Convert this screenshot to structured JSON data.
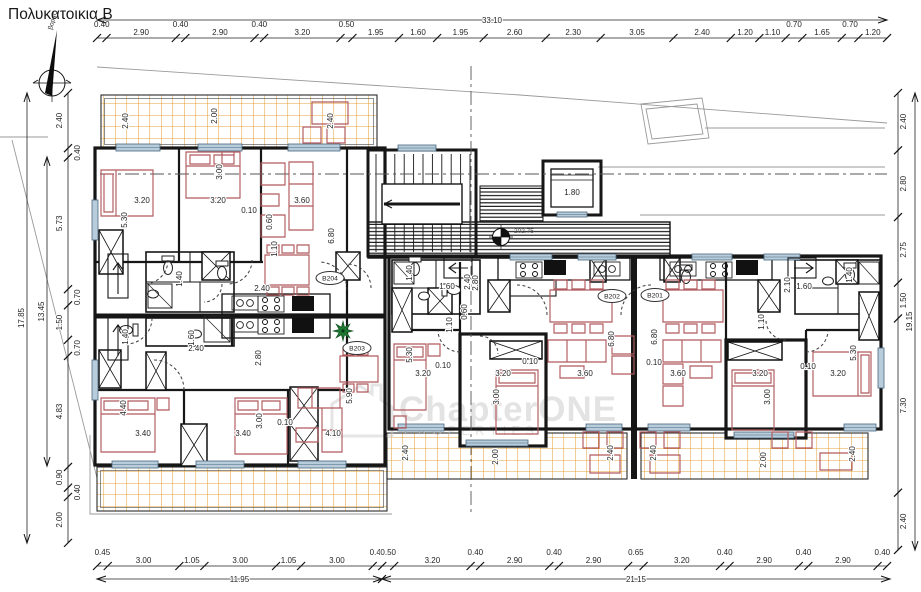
{
  "title": "Πολυκατοικια Β",
  "north_label": "βορας",
  "watermark": {
    "brand": "ChapterONE",
    "sub": "PROPERTIES"
  },
  "level_marker": "202.75",
  "apartments": [
    {
      "id": "B204",
      "x": 330,
      "y": 278
    },
    {
      "id": "B203",
      "x": 357,
      "y": 348
    },
    {
      "id": "B202",
      "x": 612,
      "y": 296
    },
    {
      "id": "B201",
      "x": 655,
      "y": 295
    }
  ],
  "chains": {
    "top": {
      "overall": "33.10",
      "segments": [
        "0.40",
        "2.90",
        "0.40",
        "2.90",
        "0.40",
        "3.20",
        "0.50",
        "1.95",
        "1.60",
        "1.95",
        "2.60",
        "2.30",
        "3.05",
        "2.40",
        "1.20",
        "1.10",
        "0.70",
        "1.65",
        "0.70",
        "1.20"
      ]
    },
    "bottom": {
      "overall_left": "11.95",
      "overall_right": "21.15",
      "segments": [
        "0.45",
        "3.00",
        "1.05",
        "3.00",
        "1.05",
        "3.00",
        "0.40",
        "0.50",
        "3.20",
        "0.40",
        "2.90",
        "0.40",
        "2.90",
        "0.65",
        "3.20",
        "0.40",
        "2.90",
        "0.40",
        "2.90",
        "0.40"
      ]
    },
    "left": {
      "overall_outer": "17.85",
      "overall_inner": "13.45",
      "segments": [
        "2.40",
        "0.40",
        "5.73",
        "0.70",
        "1.50",
        "0.70",
        "4.83",
        "0.90",
        "0.40",
        "2.00"
      ]
    },
    "right": {
      "overall": "19.15",
      "segments": [
        "2.40",
        "2.80",
        "2.75",
        "1.50",
        "7.30",
        "2.40"
      ]
    }
  },
  "interior_dimensions": [
    {
      "t": "3.20",
      "x": 142,
      "y": 203
    },
    {
      "t": "3.20",
      "x": 218,
      "y": 203
    },
    {
      "t": "3.60",
      "x": 302,
      "y": 203
    },
    {
      "t": "0.10",
      "x": 249,
      "y": 213
    },
    {
      "t": "5.30",
      "x": 127,
      "y": 220,
      "r": -90
    },
    {
      "t": "3.00",
      "x": 222,
      "y": 172,
      "r": -90
    },
    {
      "t": "6.80",
      "x": 334,
      "y": 236,
      "r": -90
    },
    {
      "t": "0.60",
      "x": 272,
      "y": 222,
      "r": -90
    },
    {
      "t": "1.10",
      "x": 277,
      "y": 249,
      "r": -90
    },
    {
      "t": "1.40",
      "x": 182,
      "y": 279,
      "r": -90
    },
    {
      "t": "2.80",
      "x": 478,
      "y": 283,
      "r": -90
    },
    {
      "t": "1.40",
      "x": 128,
      "y": 337,
      "r": -90
    },
    {
      "t": "1.60",
      "x": 194,
      "y": 338,
      "r": -90
    },
    {
      "t": "2.40",
      "x": 196,
      "y": 351
    },
    {
      "t": "2.80",
      "x": 261,
      "y": 358,
      "r": -90
    },
    {
      "t": "2.40",
      "x": 262,
      "y": 291
    },
    {
      "t": "3.40",
      "x": 143,
      "y": 436
    },
    {
      "t": "3.40",
      "x": 243,
      "y": 436
    },
    {
      "t": "4.10",
      "x": 333,
      "y": 436
    },
    {
      "t": "0.10",
      "x": 285,
      "y": 425
    },
    {
      "t": "4.40",
      "x": 126,
      "y": 408,
      "r": -90
    },
    {
      "t": "3.00",
      "x": 262,
      "y": 421,
      "r": -90
    },
    {
      "t": "5.90",
      "x": 352,
      "y": 396,
      "r": -90
    },
    {
      "t": "3.20",
      "x": 423,
      "y": 376
    },
    {
      "t": "3.20",
      "x": 503,
      "y": 376
    },
    {
      "t": "3.60",
      "x": 585,
      "y": 376
    },
    {
      "t": "0.10",
      "x": 443,
      "y": 368
    },
    {
      "t": "0.10",
      "x": 530,
      "y": 364
    },
    {
      "t": "5.30",
      "x": 412,
      "y": 355,
      "r": -90
    },
    {
      "t": "3.00",
      "x": 499,
      "y": 397,
      "r": -90
    },
    {
      "t": "6.80",
      "x": 614,
      "y": 339,
      "r": -90
    },
    {
      "t": "1.10",
      "x": 452,
      "y": 325,
      "r": -90
    },
    {
      "t": "0.60",
      "x": 467,
      "y": 312,
      "r": -90
    },
    {
      "t": "1.40",
      "x": 412,
      "y": 273,
      "r": -90
    },
    {
      "t": "2.40",
      "x": 470,
      "y": 282,
      "r": -90
    },
    {
      "t": "1.60",
      "x": 447,
      "y": 289
    },
    {
      "t": "3.60",
      "x": 678,
      "y": 376
    },
    {
      "t": "3.20",
      "x": 760,
      "y": 376
    },
    {
      "t": "3.20",
      "x": 838,
      "y": 376
    },
    {
      "t": "0.10",
      "x": 654,
      "y": 365
    },
    {
      "t": "0.10",
      "x": 808,
      "y": 369
    },
    {
      "t": "6.80",
      "x": 657,
      "y": 337,
      "r": -90
    },
    {
      "t": "3.00",
      "x": 770,
      "y": 397,
      "r": -90
    },
    {
      "t": "5.30",
      "x": 856,
      "y": 353,
      "r": -90
    },
    {
      "t": "1.10",
      "x": 764,
      "y": 322,
      "r": -90
    },
    {
      "t": "2.10",
      "x": 790,
      "y": 285,
      "r": -90
    },
    {
      "t": "1.60",
      "x": 804,
      "y": 289
    },
    {
      "t": "1.40",
      "x": 852,
      "y": 275,
      "r": -90
    },
    {
      "t": "2.40",
      "x": 128,
      "y": 121,
      "r": -90
    },
    {
      "t": "2.00",
      "x": 217,
      "y": 116,
      "r": -90
    },
    {
      "t": "2.40",
      "x": 333,
      "y": 121,
      "r": -90
    },
    {
      "t": "2.40",
      "x": 408,
      "y": 453,
      "r": -90
    },
    {
      "t": "2.00",
      "x": 498,
      "y": 457,
      "r": -90
    },
    {
      "t": "2.40",
      "x": 613,
      "y": 453,
      "r": -90
    },
    {
      "t": "2.40",
      "x": 656,
      "y": 453,
      "r": -90
    },
    {
      "t": "2.00",
      "x": 766,
      "y": 460,
      "r": -90
    },
    {
      "t": "2.40",
      "x": 855,
      "y": 454,
      "r": -90
    },
    {
      "t": "1.80",
      "x": 572,
      "y": 195
    }
  ]
}
